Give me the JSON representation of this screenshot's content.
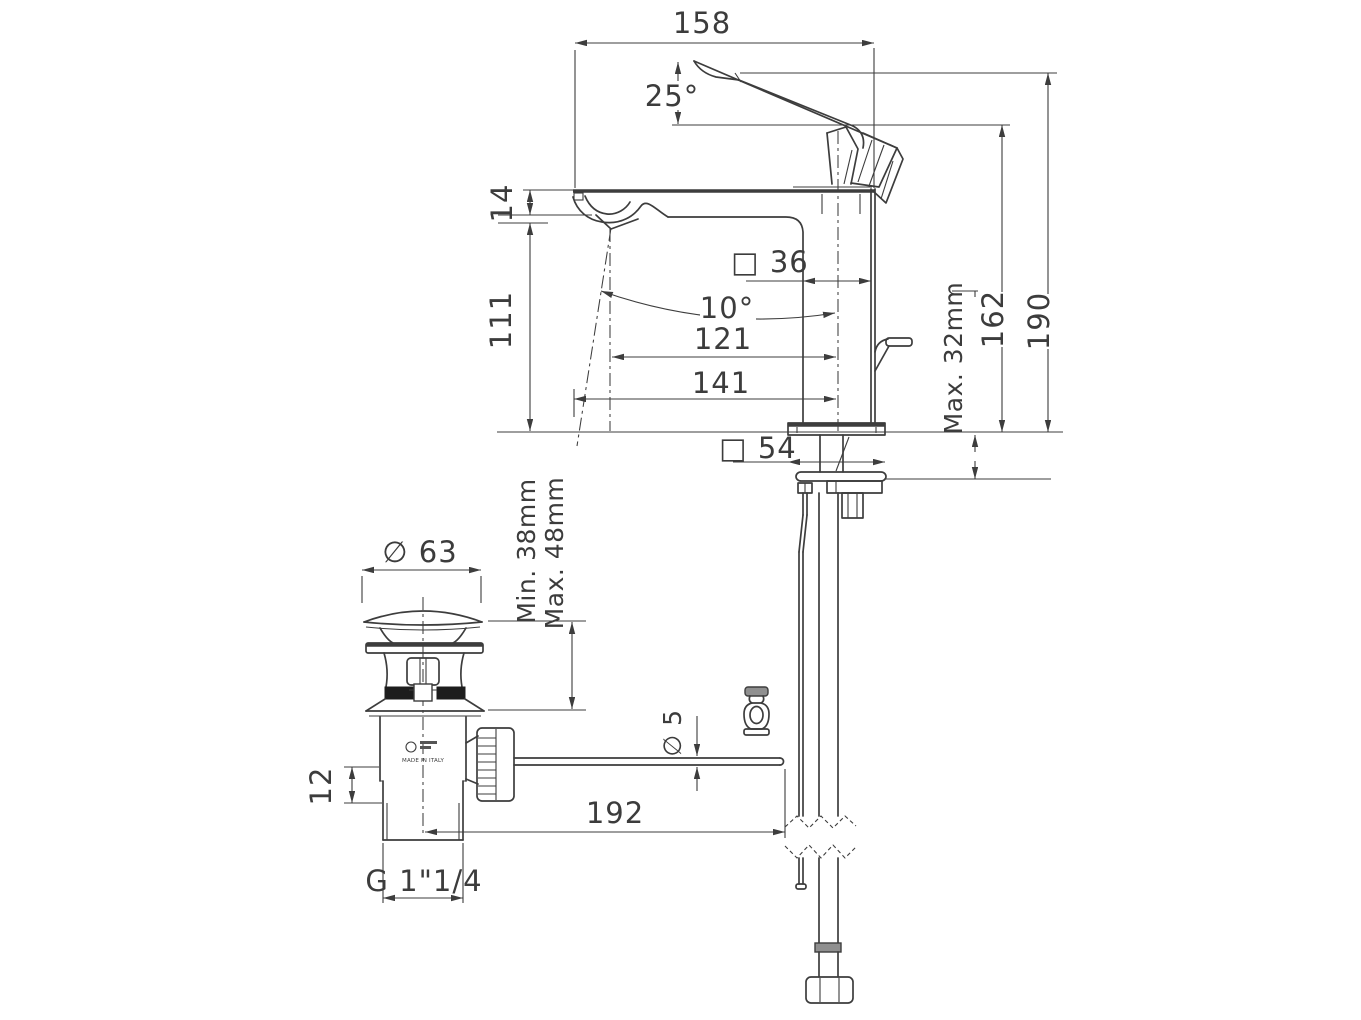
{
  "drawing": {
    "colors": {
      "line": "#3d3d3d",
      "background": "#ffffff",
      "fill_dark": "#1d1d1d",
      "fill_gray": "#8f8f8f"
    },
    "dims": {
      "spout_reach": "158",
      "handle_angle": "25°",
      "spout_tip_thickness": "14",
      "spout_clearance": "111",
      "body_section": "□ 36",
      "stream_angle": "10°",
      "aerator_to_axis": "121",
      "tip_to_axis": "141",
      "spout_height": "162",
      "overall_height": "190",
      "deck_max": "Max. 32mm",
      "base_section": "□ 54",
      "waste_cap_dia": "∅ 63",
      "waste_min": "Min. 38mm",
      "waste_max": "Max. 48mm",
      "rod_dia": "∅ 5",
      "rod_offset": "12",
      "rod_length": "192",
      "waste_thread": "G 1\"1/4"
    },
    "marks": {
      "made_in": "MADE IN ITALY"
    }
  }
}
